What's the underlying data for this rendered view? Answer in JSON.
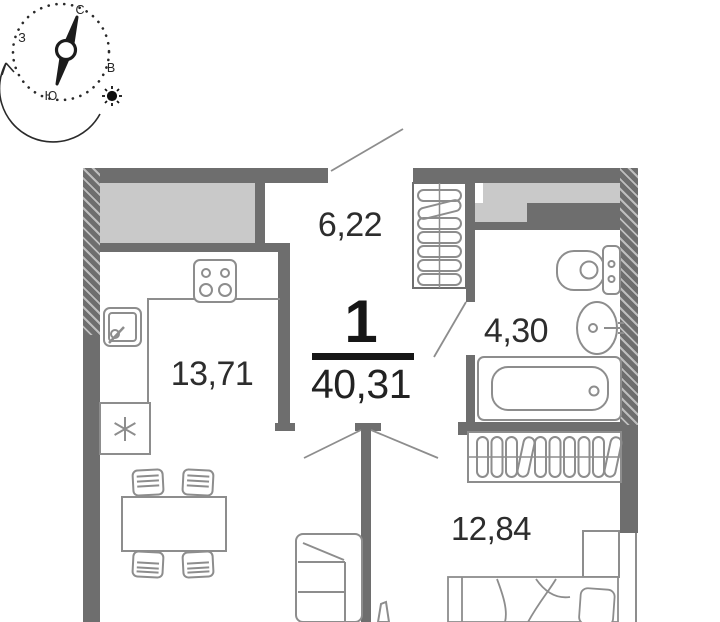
{
  "page": {
    "type": "apartment-floor-plan"
  },
  "compass": {
    "north": "С",
    "east": "В",
    "south": "Ю",
    "west": "З"
  },
  "apartment": {
    "rooms_count": "1",
    "total_area": "40,31"
  },
  "rooms": {
    "hallway": {
      "area": "6,22"
    },
    "kitchen_living": {
      "area": "13,71"
    },
    "bathroom": {
      "area": "4,30"
    },
    "bedroom": {
      "area": "12,84"
    }
  },
  "colors": {
    "wall": "#6e6e6e",
    "light_fill": "#c9c9c9",
    "furniture_line": "#8d8d8d",
    "label_text": "#2d2d2d",
    "accent_black": "#161616"
  },
  "icons": {
    "compass": "compass-rose-icon",
    "sun": "sun-icon",
    "direction_arrow": "curved-arrow-icon",
    "fridge": "asterisk-icon"
  }
}
